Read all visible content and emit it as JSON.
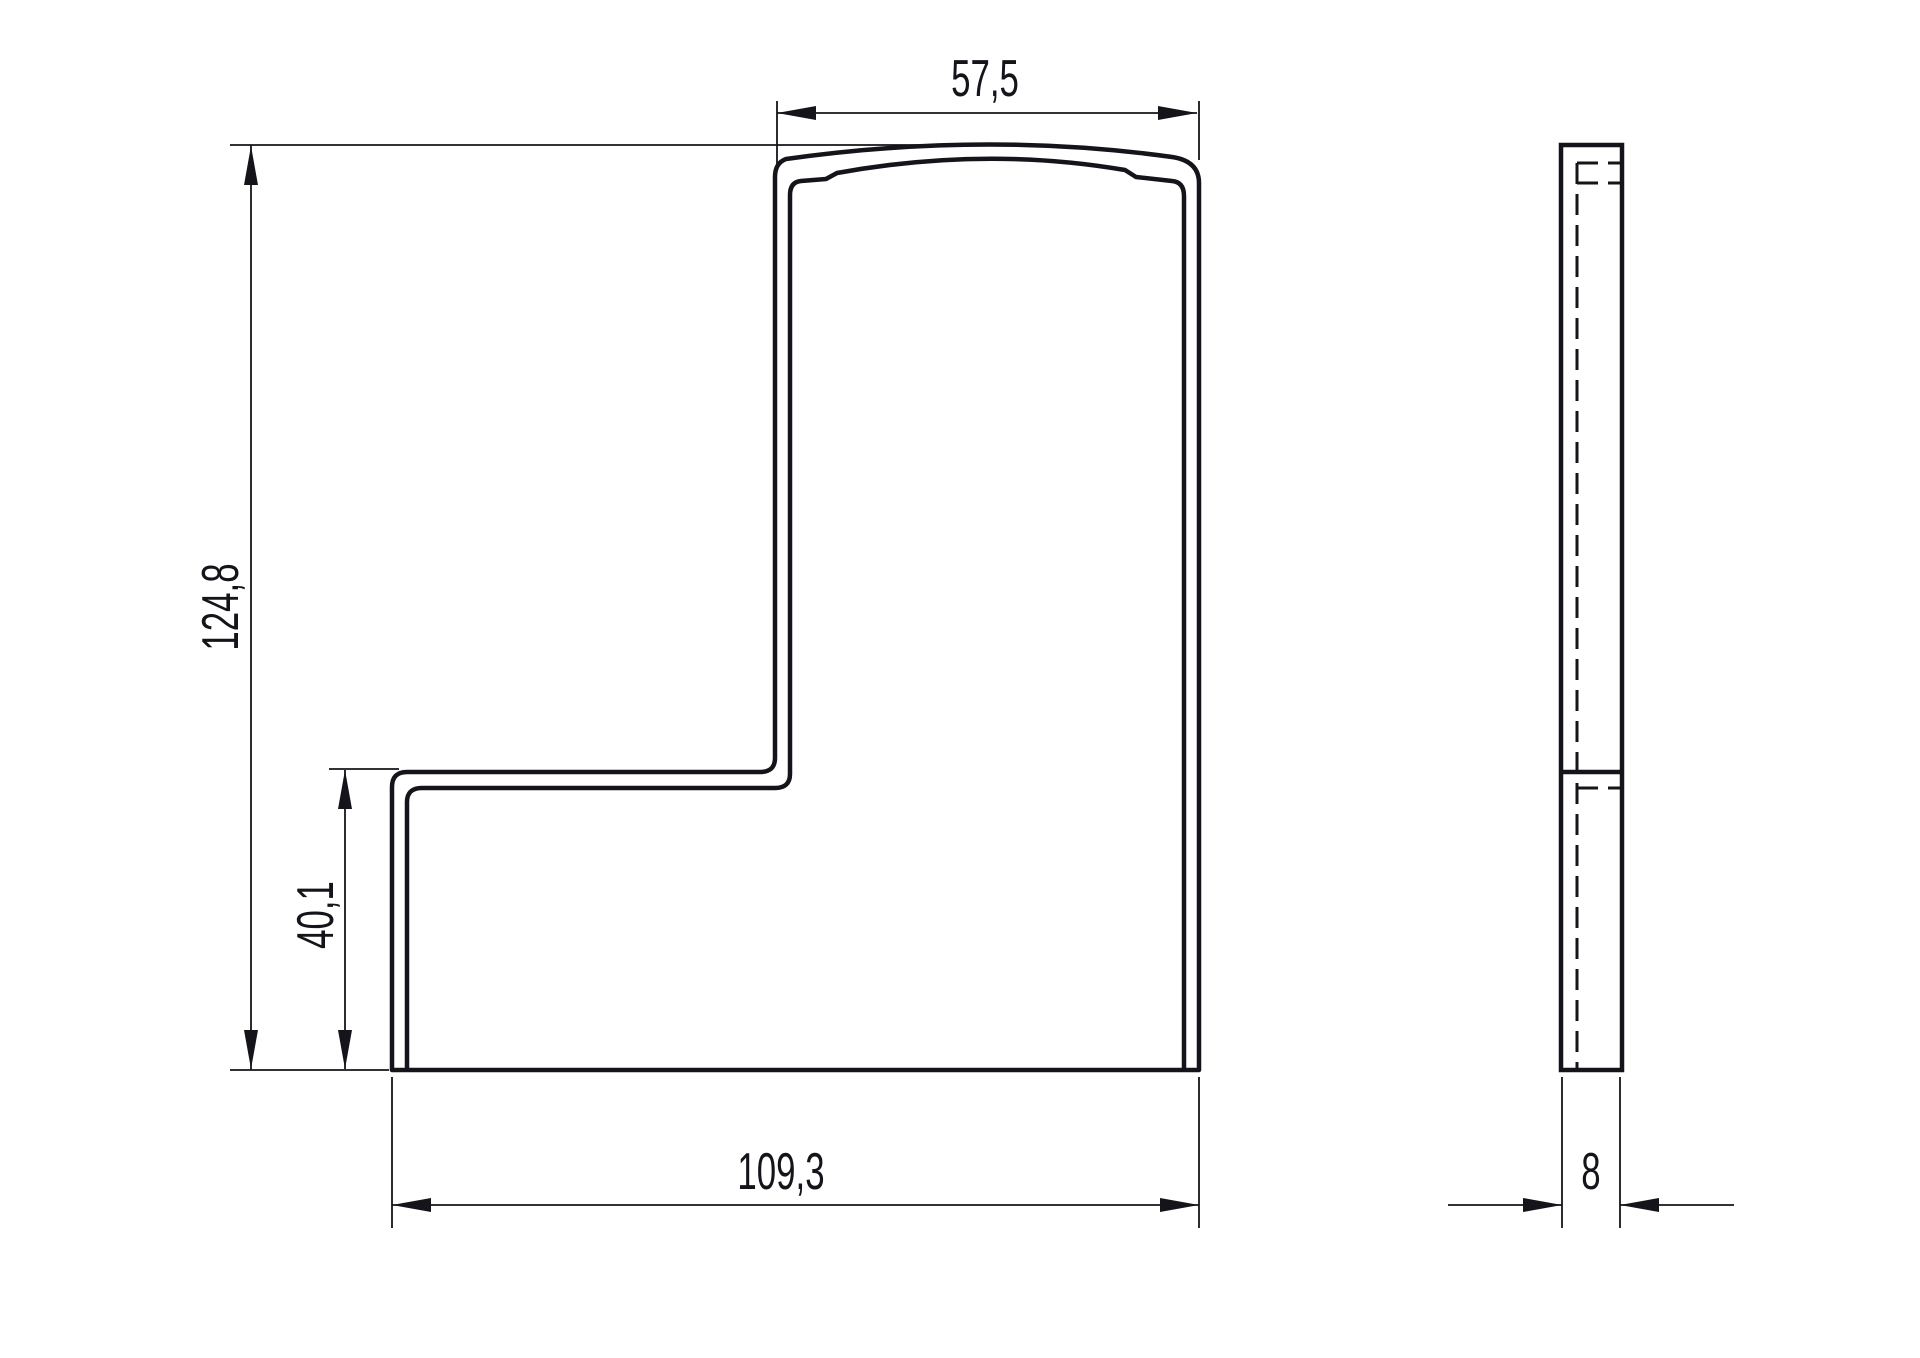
{
  "colors": {
    "background": "#ffffff",
    "line": "#14141a"
  },
  "dimensions": {
    "top_width": "57,5",
    "total_height": "124,8",
    "step_height": "40,1",
    "bottom_width": "109,3",
    "thickness": "8"
  }
}
